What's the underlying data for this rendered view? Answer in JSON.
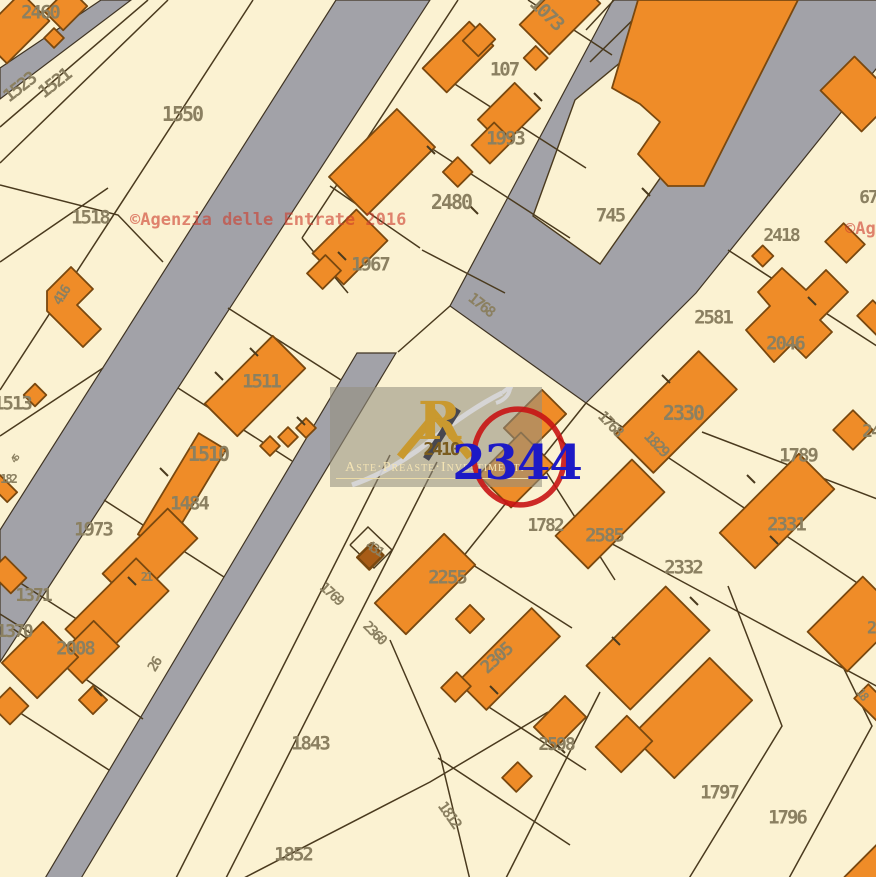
{
  "colors": {
    "background": "#fbf2d2",
    "road": "#a2a2a8",
    "building": "#ef8c28",
    "building_border": "#79480f",
    "boundary_line": "#4a3a1e",
    "label": "#8b8061",
    "label_gold": "#7a5c1e",
    "agenzia_red": "#cd3e2d",
    "circle_red": "#c81414",
    "parcel_blue": "#1d1ac6",
    "logo_gold": "#c9992f"
  },
  "watermark": {
    "agenzia": "©Agenzia delle Entrate 2016"
  },
  "logo": {
    "monogram": "R",
    "brand": "Aste·Preaste·Investimenti"
  },
  "highlight": {
    "parcel": "2344"
  },
  "map": {
    "labels": [
      {
        "t": "2460",
        "x": 40,
        "y": 13,
        "r": 0,
        "s": 19
      },
      {
        "t": "1523",
        "x": 20,
        "y": 88,
        "r": -38,
        "s": 18
      },
      {
        "t": "1521",
        "x": 55,
        "y": 84,
        "r": -38,
        "s": 18
      },
      {
        "t": "1550",
        "x": 182,
        "y": 114,
        "r": 0,
        "s": 20
      },
      {
        "t": "1518",
        "x": 90,
        "y": 218,
        "r": 0,
        "s": 19
      },
      {
        "t": "1073",
        "x": 546,
        "y": 14,
        "r": 44,
        "s": 19
      },
      {
        "t": "107",
        "x": 504,
        "y": 70,
        "r": 0,
        "s": 19
      },
      {
        "t": "1993",
        "x": 505,
        "y": 139,
        "r": 0,
        "s": 19
      },
      {
        "t": "2480",
        "x": 451,
        "y": 202,
        "r": 0,
        "s": 20
      },
      {
        "t": "1967",
        "x": 370,
        "y": 265,
        "r": 0,
        "s": 19
      },
      {
        "t": "745",
        "x": 610,
        "y": 216,
        "r": 0,
        "s": 19
      },
      {
        "t": "2418",
        "x": 781,
        "y": 236,
        "r": 0,
        "s": 18
      },
      {
        "t": "67",
        "x": 868,
        "y": 198,
        "r": 0,
        "s": 18
      },
      {
        "t": "2581",
        "x": 713,
        "y": 318,
        "r": 0,
        "s": 19
      },
      {
        "t": "2046",
        "x": 785,
        "y": 344,
        "r": 0,
        "s": 19
      },
      {
        "t": "2330",
        "x": 683,
        "y": 413,
        "r": 0,
        "s": 20
      },
      {
        "t": "1768",
        "x": 481,
        "y": 305,
        "r": 38,
        "s": 15
      },
      {
        "t": "1768",
        "x": 610,
        "y": 424,
        "r": 46,
        "s": 15
      },
      {
        "t": "1829",
        "x": 656,
        "y": 444,
        "r": 46,
        "s": 15
      },
      {
        "t": "1789",
        "x": 798,
        "y": 456,
        "r": 0,
        "s": 19
      },
      {
        "t": "24",
        "x": 871,
        "y": 432,
        "r": 0,
        "s": 18
      },
      {
        "t": "1513",
        "x": 12,
        "y": 404,
        "r": 0,
        "s": 19
      },
      {
        "t": "416",
        "x": 62,
        "y": 296,
        "r": -58,
        "s": 14
      },
      {
        "t": "45",
        "x": 16,
        "y": 460,
        "r": -55,
        "s": 9
      },
      {
        "t": "182",
        "x": 8,
        "y": 479,
        "r": 0,
        "s": 12
      },
      {
        "t": "1511",
        "x": 261,
        "y": 382,
        "r": 0,
        "s": 19
      },
      {
        "t": "1510",
        "x": 208,
        "y": 454,
        "r": 0,
        "s": 20
      },
      {
        "t": "1484",
        "x": 189,
        "y": 504,
        "r": 0,
        "s": 19
      },
      {
        "t": "1973",
        "x": 93,
        "y": 530,
        "r": 0,
        "s": 19
      },
      {
        "t": "21",
        "x": 146,
        "y": 577,
        "r": 0,
        "s": 12
      },
      {
        "t": "2410",
        "x": 441,
        "y": 450,
        "r": 0,
        "s": 18,
        "c": "#7a5c1e"
      },
      {
        "t": "1782",
        "x": 545,
        "y": 526,
        "r": 0,
        "s": 18
      },
      {
        "t": "2585",
        "x": 604,
        "y": 536,
        "r": 0,
        "s": 19
      },
      {
        "t": "2332",
        "x": 683,
        "y": 568,
        "r": 0,
        "s": 19
      },
      {
        "t": "2331",
        "x": 786,
        "y": 525,
        "r": 0,
        "s": 19
      },
      {
        "t": "2255",
        "x": 447,
        "y": 578,
        "r": 0,
        "s": 19
      },
      {
        "t": "431",
        "x": 374,
        "y": 549,
        "r": 33,
        "s": 13
      },
      {
        "t": "1371",
        "x": 33,
        "y": 596,
        "r": 0,
        "s": 18
      },
      {
        "t": "1370",
        "x": 14,
        "y": 632,
        "r": 0,
        "s": 18
      },
      {
        "t": "2008",
        "x": 75,
        "y": 649,
        "r": 0,
        "s": 19
      },
      {
        "t": "26",
        "x": 155,
        "y": 665,
        "r": -58,
        "s": 14
      },
      {
        "t": "1769",
        "x": 331,
        "y": 594,
        "r": 42,
        "s": 14
      },
      {
        "t": "2360",
        "x": 374,
        "y": 633,
        "r": 45,
        "s": 14
      },
      {
        "t": "1843",
        "x": 310,
        "y": 744,
        "r": 0,
        "s": 19
      },
      {
        "t": "1852",
        "x": 293,
        "y": 855,
        "r": 0,
        "s": 19
      },
      {
        "t": "1812",
        "x": 449,
        "y": 815,
        "r": 55,
        "s": 15
      },
      {
        "t": "2305",
        "x": 497,
        "y": 659,
        "r": -42,
        "s": 18
      },
      {
        "t": "2598",
        "x": 556,
        "y": 745,
        "r": 0,
        "s": 18
      },
      {
        "t": "1797",
        "x": 719,
        "y": 793,
        "r": 0,
        "s": 19
      },
      {
        "t": "1796",
        "x": 787,
        "y": 818,
        "r": 0,
        "s": 19
      },
      {
        "t": "18",
        "x": 862,
        "y": 694,
        "r": 52,
        "s": 12
      },
      {
        "t": "2",
        "x": 871,
        "y": 629,
        "r": 0,
        "s": 17
      }
    ]
  }
}
